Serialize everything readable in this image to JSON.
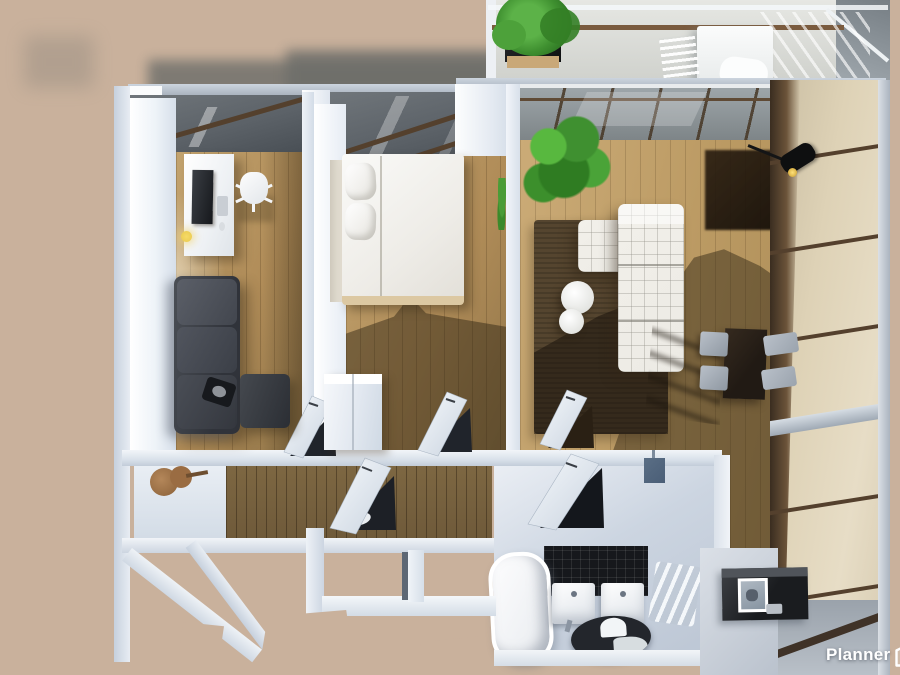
{
  "watermark": {
    "brand": "Planner",
    "logo_text": "5d"
  },
  "palette": {
    "background_beige": "#c9b19c",
    "shadow_gray": "#6c6d69",
    "wall_light": "#dde4ee",
    "wall_bright": "#f7f9fc",
    "wall_shade": "#b9c4d4",
    "wood_light": "#c2a36f",
    "wood_mid": "#b08c58",
    "wood_shadow": "#6e5f43",
    "wood_panel": "#6f5a3a",
    "glass_dark": "#5c6268",
    "glass_roof": "#939ca0",
    "glass_beige": "#ded2b6",
    "frame_brown": "#54402d",
    "metal_gray": "#aab3bf",
    "sofa_white": "#eceae4",
    "sofa_dark": "#3c3f45",
    "rug_brown": "#55452f",
    "plant_green": "#44982f",
    "tile_black": "#16181c",
    "bath_floor": "#ccd5e1",
    "accent_blue": "#4a5e77",
    "lamp_yellow": "#e9c94d",
    "table_dark": "#211a14",
    "chair_gray": "#9aa3ad",
    "balcony_floor": "#d8d9d5",
    "watermark_white": "#ffffff"
  },
  "scene": {
    "type": "3d-floorplan-top-view-render",
    "rooms": [
      "balcony",
      "home-office",
      "bedroom",
      "living-room",
      "dining-area",
      "hallway",
      "bathroom"
    ],
    "objects": [
      "potted-plant",
      "patio-table",
      "patio-chairs",
      "desk",
      "monitor",
      "office-chair",
      "desk-lamp",
      "dark-sofa",
      "double-bed",
      "pillows",
      "wardrobe",
      "monstera-plant",
      "white-sectional-sofa",
      "round-coffee-tables",
      "brown-rug",
      "dining-table",
      "dining-chairs",
      "track-spotlight",
      "glass-panel-wall",
      "open-doors",
      "wall-guitar",
      "bathtub",
      "twin-sinks",
      "oval-floor-mirror",
      "radiator",
      "wall-mounted-cabinet",
      "black-vanity-counter",
      "framed-picture"
    ]
  }
}
